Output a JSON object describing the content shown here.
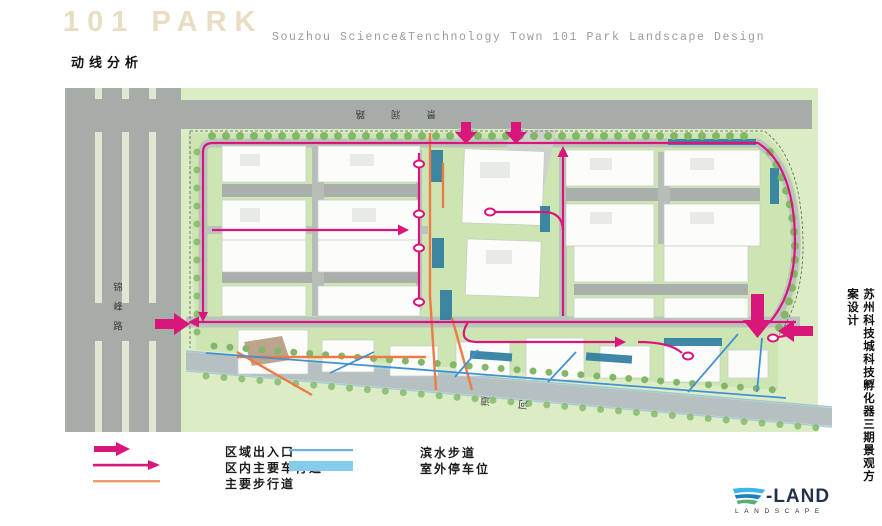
{
  "header": {
    "brand": "101 PARK",
    "subtitle": "Souzhou Science&Tenchnology Town 101 Park Landscape Design",
    "page_title": "动线分析"
  },
  "map": {
    "labels": {
      "top_road": "景润路",
      "left_road": "锦峰路",
      "river": "河道"
    },
    "side_title": "苏州科技城科技孵化器三期景观方案设计"
  },
  "legend": {
    "col1": [
      {
        "label": "区域出入口"
      },
      {
        "label": "区内主要车行道"
      },
      {
        "label": "主要步行道"
      }
    ],
    "col2": [
      {
        "label": "滨水步道"
      },
      {
        "label": "室外停车位"
      }
    ]
  },
  "logo": {
    "brand": "-LAND",
    "tagline": "LANDSCAPE"
  },
  "colors": {
    "route_magenta": "#d9177b",
    "pedestrian_orange": "#ee7a46",
    "waterfront_blue": "#4491d2",
    "parking_legend_blue": "#85cbec",
    "parking_map_teal": "#2f7e9f",
    "road_gray": "#a6ada8",
    "site_green": "#cde4b3"
  }
}
